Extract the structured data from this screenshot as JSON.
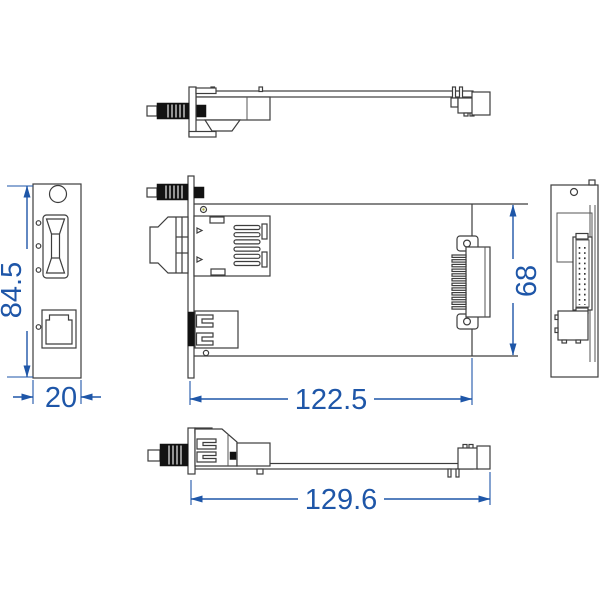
{
  "drawing": {
    "type": "mechanical-cad-multiview",
    "views": [
      "top-edge-view",
      "front-panel-view",
      "plan-view",
      "rear-panel-view",
      "bottom-edge-view"
    ],
    "dimensions": {
      "front_height": "84.5",
      "front_width": "20",
      "board_length": "122.5",
      "board_width": "68",
      "overall_length": "129.6"
    },
    "colors": {
      "dimension_blue": "#1e56a8",
      "line_dark": "#3d3d3d",
      "black_fill": "#121212",
      "hole_accent": "#a9ab3d",
      "background": "#ffffff"
    }
  }
}
